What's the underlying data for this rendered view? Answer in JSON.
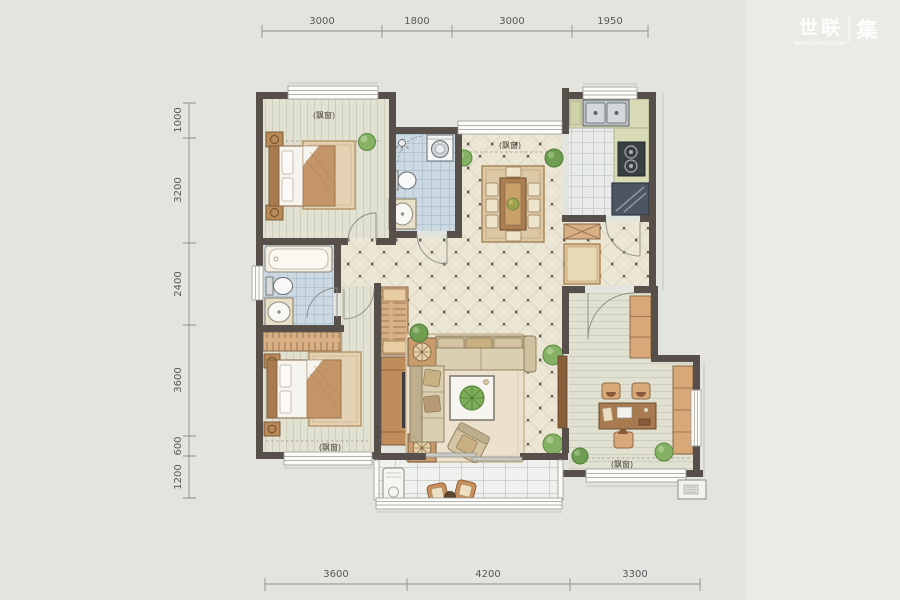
{
  "watermark": {
    "brand": "世联",
    "mark": "集",
    "site": "worldunionji.com"
  },
  "dimensions": {
    "top": [
      "3000",
      "1800",
      "3000",
      "1950"
    ],
    "left": [
      "1000",
      "3200",
      "2400",
      "3600",
      "600",
      "1200"
    ],
    "bottom": [
      "3600",
      "4200",
      "3300"
    ]
  },
  "room_labels": {
    "bay_window": "(飘窗)"
  },
  "colors": {
    "background": "#e4e4df",
    "wall": "#57504a",
    "wood_floor": "#e2e2d2",
    "hall_tile": "#ece6d5",
    "bath_tile": "#ccd9e2",
    "kitchen_tile": "#e9ebea",
    "balcony_tile": "#eff1ef",
    "furniture_wood": "#c89a6e",
    "counter": "#d9dab6",
    "plant": "#85b164",
    "dimension_text": "#57575a"
  }
}
